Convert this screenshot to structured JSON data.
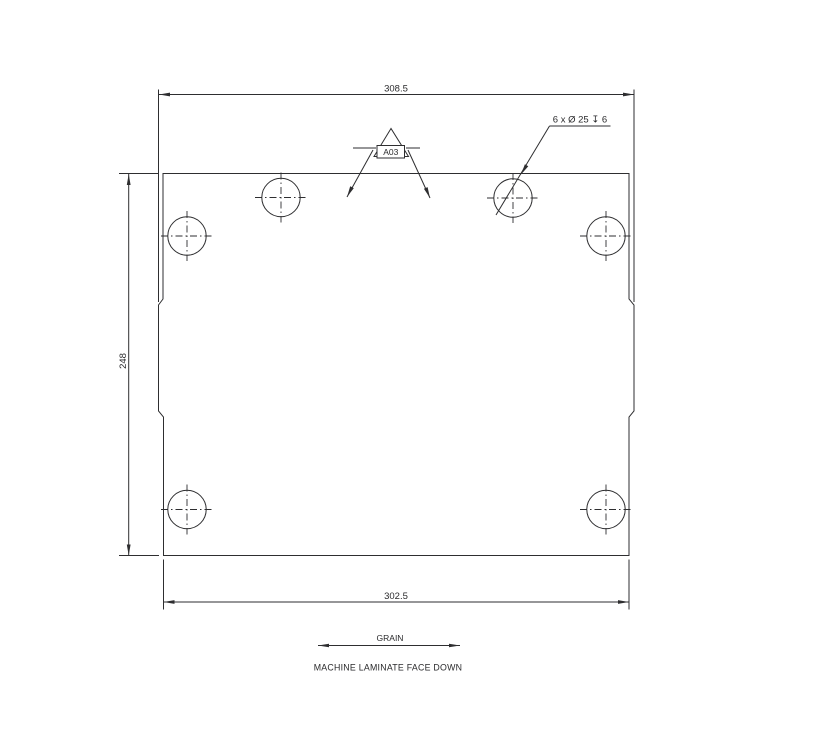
{
  "drawing": {
    "background_color": "#ffffff",
    "line_color": "#2e2e30",
    "hole_count": 6,
    "dimensions": {
      "top_width": "308.5",
      "left_height": "248",
      "bottom_width": "302.5"
    },
    "hole_callout": "6 x Ø 25 ↧ 6",
    "edge_band_tag": "A03",
    "grain_label": "GRAIN",
    "process_note": "MACHINE LAMINATE FACE DOWN"
  }
}
